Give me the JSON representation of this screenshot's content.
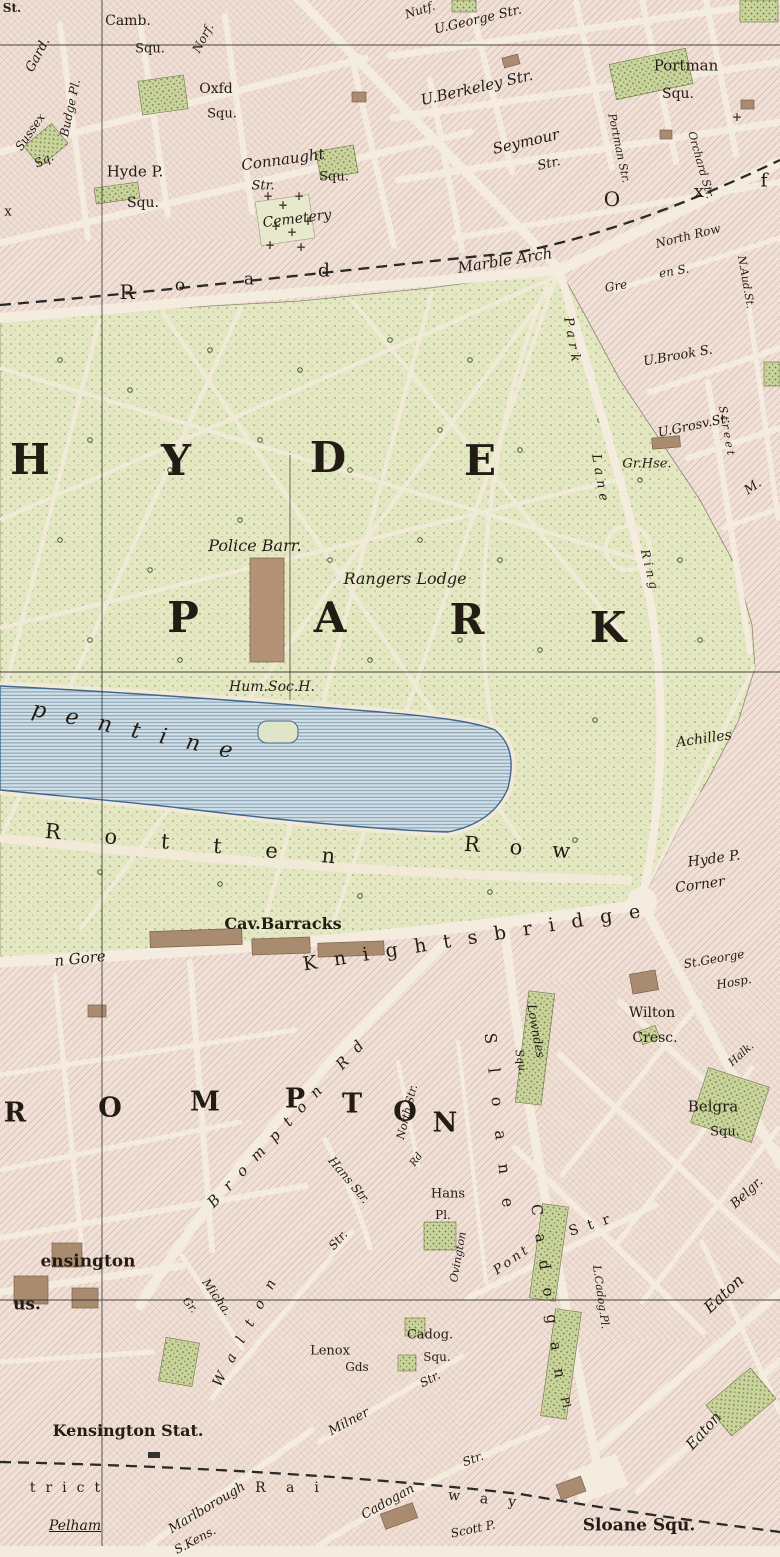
{
  "map": {
    "title": "Hyde Park and Knightsbridge district map sheet",
    "colors": {
      "paper": "#f4ecdf",
      "block_base": "#f0e1d8",
      "block_hatch": "#d3ab9d",
      "park_green": "#e3e8c2",
      "garden_green": "#c9d49c",
      "water_fill": "#d3e0e6",
      "water_ripple": "#7d9cb0",
      "water_outline": "#3f688c",
      "building_brown": "#a98b70",
      "ink": "#221c14"
    },
    "labels": [
      {
        "t": "St.",
        "x": 12,
        "y": 8,
        "s": 12,
        "c": "b"
      },
      {
        "t": "Gard.",
        "x": 38,
        "y": 55,
        "s": 13,
        "r": -62,
        "c": "it"
      },
      {
        "t": "Camb.",
        "x": 128,
        "y": 21,
        "s": 14
      },
      {
        "t": "Squ.",
        "x": 150,
        "y": 49,
        "s": 13
      },
      {
        "t": "Norf.",
        "x": 203,
        "y": 38,
        "s": 12,
        "r": -62,
        "c": "it"
      },
      {
        "t": "Nutf.",
        "x": 420,
        "y": 10,
        "s": 12,
        "r": -18,
        "c": "it"
      },
      {
        "t": "U.George Str.",
        "x": 478,
        "y": 20,
        "s": 13,
        "r": -13,
        "c": "it"
      },
      {
        "t": "Portman",
        "x": 686,
        "y": 66,
        "s": 15
      },
      {
        "t": "Squ.",
        "x": 678,
        "y": 94,
        "s": 14
      },
      {
        "t": "Budge Pl.",
        "x": 70,
        "y": 108,
        "s": 12,
        "r": -78,
        "c": "it"
      },
      {
        "t": "Oxfd",
        "x": 216,
        "y": 89,
        "s": 14
      },
      {
        "t": "Squ.",
        "x": 222,
        "y": 114,
        "s": 13
      },
      {
        "t": "Sussex",
        "x": 30,
        "y": 132,
        "s": 12,
        "r": -55,
        "c": "it"
      },
      {
        "t": "Sq.",
        "x": 44,
        "y": 160,
        "s": 12,
        "r": -25,
        "c": "it"
      },
      {
        "t": "U.Berkeley Str.",
        "x": 477,
        "y": 88,
        "s": 15,
        "r": -13,
        "c": "it"
      },
      {
        "t": "Connaught",
        "x": 283,
        "y": 160,
        "s": 15,
        "r": -8,
        "c": "it"
      },
      {
        "t": "Str.",
        "x": 263,
        "y": 186,
        "s": 13,
        "c": "it"
      },
      {
        "t": "Squ.",
        "x": 334,
        "y": 177,
        "s": 13
      },
      {
        "t": "Hyde P.",
        "x": 135,
        "y": 172,
        "s": 15
      },
      {
        "t": "Squ.",
        "x": 143,
        "y": 203,
        "s": 14
      },
      {
        "t": "Seymour",
        "x": 526,
        "y": 142,
        "s": 15,
        "r": -13,
        "c": "it"
      },
      {
        "t": "Str.",
        "x": 549,
        "y": 164,
        "s": 13,
        "r": -13,
        "c": "it"
      },
      {
        "t": "Portman Str.",
        "x": 619,
        "y": 148,
        "s": 11,
        "r": 78,
        "c": "it"
      },
      {
        "t": "Orchard Str.",
        "x": 701,
        "y": 165,
        "s": 11,
        "r": 74,
        "c": "it"
      },
      {
        "t": "Cemetery",
        "x": 297,
        "y": 219,
        "s": 14,
        "r": -7,
        "c": "it"
      },
      {
        "t": "Marble Arch",
        "x": 505,
        "y": 261,
        "s": 15,
        "r": -9,
        "c": "it"
      },
      {
        "t": "R",
        "x": 127,
        "y": 292,
        "s": 20
      },
      {
        "t": "o",
        "x": 180,
        "y": 286,
        "s": 17
      },
      {
        "t": "a",
        "x": 249,
        "y": 280,
        "s": 17
      },
      {
        "t": "d",
        "x": 324,
        "y": 271,
        "s": 19
      },
      {
        "t": "O",
        "x": 612,
        "y": 199,
        "s": 20
      },
      {
        "t": "x",
        "x": 699,
        "y": 192,
        "s": 18
      },
      {
        "t": "f",
        "x": 764,
        "y": 181,
        "s": 19
      },
      {
        "t": "North Row",
        "x": 688,
        "y": 236,
        "s": 12,
        "r": -14,
        "c": "it"
      },
      {
        "t": "Gre",
        "x": 616,
        "y": 286,
        "s": 12,
        "r": -10,
        "c": "it"
      },
      {
        "t": "en S.",
        "x": 674,
        "y": 271,
        "s": 12,
        "r": -10,
        "c": "it"
      },
      {
        "t": "N.Aud.St.",
        "x": 746,
        "y": 282,
        "s": 11,
        "r": 80,
        "c": "it"
      },
      {
        "t": "U.Brook S.",
        "x": 678,
        "y": 356,
        "s": 13,
        "r": -10,
        "c": "it"
      },
      {
        "t": "U.Grosv.St.",
        "x": 694,
        "y": 426,
        "s": 13,
        "r": -12,
        "c": "it"
      },
      {
        "t": "Gr.Hse.",
        "x": 647,
        "y": 464,
        "s": 13,
        "c": "it"
      },
      {
        "t": "Street",
        "x": 727,
        "y": 432,
        "s": 11,
        "r": 80,
        "ls": 3,
        "c": "it"
      },
      {
        "t": "M.",
        "x": 753,
        "y": 487,
        "s": 13,
        "r": -35,
        "c": "it"
      },
      {
        "t": "Park",
        "x": 572,
        "y": 342,
        "s": 13,
        "r": 80,
        "ls": 5,
        "c": "it"
      },
      {
        "t": "Lane",
        "x": 600,
        "y": 480,
        "s": 13,
        "r": 80,
        "ls": 5,
        "c": "it"
      },
      {
        "t": "Ring",
        "x": 650,
        "y": 571,
        "s": 12,
        "r": 76,
        "ls": 4,
        "c": "it"
      },
      {
        "t": "H",
        "x": 30,
        "y": 460,
        "s": 42,
        "c": "big"
      },
      {
        "t": "Y",
        "x": 176,
        "y": 461,
        "s": 42,
        "c": "big"
      },
      {
        "t": "D",
        "x": 328,
        "y": 458,
        "s": 42,
        "c": "big"
      },
      {
        "t": "E",
        "x": 480,
        "y": 461,
        "s": 42,
        "c": "big"
      },
      {
        "t": "P",
        "x": 183,
        "y": 618,
        "s": 42,
        "c": "big"
      },
      {
        "t": "A",
        "x": 330,
        "y": 618,
        "s": 42,
        "c": "big"
      },
      {
        "t": "R",
        "x": 467,
        "y": 620,
        "s": 42,
        "c": "big"
      },
      {
        "t": "K",
        "x": 608,
        "y": 628,
        "s": 42,
        "c": "big"
      },
      {
        "t": "Police Barr.",
        "x": 255,
        "y": 546,
        "s": 16,
        "c": "it"
      },
      {
        "t": "Rangers Lodge",
        "x": 405,
        "y": 579,
        "s": 16,
        "c": "it"
      },
      {
        "t": "Hum.Soc.H.",
        "x": 272,
        "y": 687,
        "s": 14,
        "c": "it"
      },
      {
        "t": "Achilles",
        "x": 704,
        "y": 739,
        "s": 14,
        "r": -8,
        "c": "it"
      },
      {
        "t": "pentine",
        "x": 142,
        "y": 733,
        "s": 22,
        "r": 12,
        "ls": 20,
        "c": "it"
      },
      {
        "t": "Rotten",
        "x": 212,
        "y": 846,
        "s": 21,
        "r": 5,
        "ls": 44
      },
      {
        "t": "Row",
        "x": 532,
        "y": 849,
        "s": 21,
        "r": 4,
        "ls": 30
      },
      {
        "t": "Cav.Barracks",
        "x": 283,
        "y": 924,
        "s": 16,
        "c": "b"
      },
      {
        "t": "n Gore",
        "x": 80,
        "y": 959,
        "s": 15,
        "r": -6,
        "c": "it"
      },
      {
        "t": "Knightsbridge",
        "x": 480,
        "y": 937,
        "s": 19,
        "r": -9,
        "ls": 17
      },
      {
        "t": "Hyde P.",
        "x": 714,
        "y": 859,
        "s": 14,
        "r": -8,
        "c": "it"
      },
      {
        "t": "Corner",
        "x": 700,
        "y": 885,
        "s": 14,
        "r": -8,
        "c": "it"
      },
      {
        "t": "St.George",
        "x": 714,
        "y": 959,
        "s": 12,
        "r": -10,
        "c": "it"
      },
      {
        "t": "Hosp.",
        "x": 734,
        "y": 982,
        "s": 12,
        "r": -10,
        "c": "it"
      },
      {
        "t": "Lowndes",
        "x": 536,
        "y": 1031,
        "s": 12,
        "r": 80,
        "c": "it"
      },
      {
        "t": "Squ.",
        "x": 521,
        "y": 1062,
        "s": 11,
        "r": 80,
        "c": "it"
      },
      {
        "t": "Wilton",
        "x": 652,
        "y": 1013,
        "s": 14
      },
      {
        "t": "Cresc.",
        "x": 655,
        "y": 1038,
        "s": 14
      },
      {
        "t": "Halk.",
        "x": 741,
        "y": 1054,
        "s": 11,
        "r": -42,
        "c": "it"
      },
      {
        "t": "Belgra",
        "x": 713,
        "y": 1107,
        "s": 15
      },
      {
        "t": "Squ.",
        "x": 725,
        "y": 1132,
        "s": 13
      },
      {
        "t": "Sloane",
        "x": 500,
        "y": 1132,
        "s": 16,
        "r": 84,
        "ls": 24
      },
      {
        "t": "Ovington",
        "x": 458,
        "y": 1257,
        "s": 11,
        "r": -80,
        "c": "it"
      },
      {
        "t": "Cadogan",
        "x": 549,
        "y": 1300,
        "s": 15,
        "r": 82,
        "ls": 18
      },
      {
        "t": "Pl.",
        "x": 566,
        "y": 1404,
        "s": 11,
        "r": 80
      },
      {
        "t": "L.Cadog.Pl.",
        "x": 601,
        "y": 1297,
        "s": 11,
        "r": 82,
        "c": "it"
      },
      {
        "t": "Pont",
        "x": 512,
        "y": 1260,
        "s": 13,
        "r": -35,
        "ls": 3,
        "c": "it"
      },
      {
        "t": "Str",
        "x": 594,
        "y": 1224,
        "s": 14,
        "r": -18,
        "ls": 10
      },
      {
        "t": "Hans",
        "x": 448,
        "y": 1194,
        "s": 13
      },
      {
        "t": "Pl.",
        "x": 443,
        "y": 1215,
        "s": 12
      },
      {
        "t": "Hans Str.",
        "x": 349,
        "y": 1180,
        "s": 12,
        "r": 50,
        "c": "it"
      },
      {
        "t": "North Str.",
        "x": 407,
        "y": 1112,
        "s": 11,
        "r": -76,
        "c": "it"
      },
      {
        "t": "Rd",
        "x": 417,
        "y": 1160,
        "s": 10,
        "r": -55,
        "c": "it"
      },
      {
        "t": "R",
        "x": 15,
        "y": 1113,
        "s": 27,
        "c": "big"
      },
      {
        "t": "O",
        "x": 110,
        "y": 1108,
        "s": 27,
        "c": "big"
      },
      {
        "t": "M",
        "x": 205,
        "y": 1102,
        "s": 27,
        "c": "big"
      },
      {
        "t": "P",
        "x": 295,
        "y": 1099,
        "s": 27,
        "c": "big"
      },
      {
        "t": "T",
        "x": 352,
        "y": 1104,
        "s": 27,
        "c": "big"
      },
      {
        "t": "O",
        "x": 405,
        "y": 1112,
        "s": 27,
        "c": "big"
      },
      {
        "t": "N",
        "x": 445,
        "y": 1123,
        "s": 27,
        "c": "big"
      },
      {
        "t": "Brompton Rd",
        "x": 290,
        "y": 1120,
        "s": 15,
        "r": -47,
        "ls": 12,
        "c": "it"
      },
      {
        "t": "Micha.",
        "x": 217,
        "y": 1297,
        "s": 12,
        "r": 55,
        "c": "it"
      },
      {
        "t": "Gr.",
        "x": 190,
        "y": 1305,
        "s": 11,
        "r": 50,
        "c": "it"
      },
      {
        "t": "Lenox",
        "x": 330,
        "y": 1351,
        "s": 13
      },
      {
        "t": "Gds",
        "x": 357,
        "y": 1367,
        "s": 12
      },
      {
        "t": "Cadog.",
        "x": 430,
        "y": 1335,
        "s": 13
      },
      {
        "t": "Squ.",
        "x": 437,
        "y": 1357,
        "s": 12
      },
      {
        "t": "Milner",
        "x": 349,
        "y": 1422,
        "s": 13,
        "r": -28,
        "c": "it"
      },
      {
        "t": "Str.",
        "x": 430,
        "y": 1379,
        "s": 12,
        "r": -28,
        "c": "it"
      },
      {
        "t": "Walton",
        "x": 248,
        "y": 1327,
        "s": 14,
        "r": -62,
        "ls": 14,
        "c": "it"
      },
      {
        "t": "Str.",
        "x": 338,
        "y": 1240,
        "s": 12,
        "r": -48,
        "c": "it"
      },
      {
        "t": "ensington",
        "x": 88,
        "y": 1262,
        "s": 17,
        "c": "b"
      },
      {
        "t": "us.",
        "x": 27,
        "y": 1305,
        "s": 17,
        "c": "b"
      },
      {
        "t": "Kensington Stat.",
        "x": 128,
        "y": 1431,
        "s": 16,
        "c": "b"
      },
      {
        "t": "trict",
        "x": 70,
        "y": 1488,
        "s": 14,
        "ls": 10
      },
      {
        "t": "Rai",
        "x": 297,
        "y": 1488,
        "s": 14,
        "ls": 20
      },
      {
        "t": "way",
        "x": 492,
        "y": 1500,
        "s": 14,
        "ls": 20,
        "r": 6
      },
      {
        "t": "Pelham",
        "x": 75,
        "y": 1526,
        "s": 14,
        "c": "it u"
      },
      {
        "t": "Marlborough",
        "x": 207,
        "y": 1508,
        "s": 13,
        "r": -31,
        "c": "it"
      },
      {
        "t": "S.Kens.",
        "x": 195,
        "y": 1540,
        "s": 12,
        "r": -28,
        "c": "it"
      },
      {
        "t": "Cadogan",
        "x": 388,
        "y": 1502,
        "s": 13,
        "r": -29,
        "c": "it"
      },
      {
        "t": "Str.",
        "x": 473,
        "y": 1459,
        "s": 12,
        "r": -20,
        "c": "it"
      },
      {
        "t": "Scott P.",
        "x": 473,
        "y": 1529,
        "s": 12,
        "r": -12,
        "c": "it"
      },
      {
        "t": "Sloane Squ.",
        "x": 639,
        "y": 1526,
        "s": 17,
        "c": "b"
      },
      {
        "t": "Eaton",
        "x": 724,
        "y": 1294,
        "s": 16,
        "r": -43,
        "c": "it"
      },
      {
        "t": "Eaton",
        "x": 704,
        "y": 1431,
        "s": 15,
        "r": -48,
        "c": "it"
      },
      {
        "t": "Belgr.",
        "x": 747,
        "y": 1193,
        "s": 13,
        "r": -43,
        "c": "it"
      },
      {
        "t": "x",
        "x": 8,
        "y": 212,
        "s": 13
      }
    ],
    "cemetery_crosses": [
      {
        "x": 268,
        "y": 196
      },
      {
        "x": 283,
        "y": 205
      },
      {
        "x": 299,
        "y": 196
      },
      {
        "x": 276,
        "y": 226
      },
      {
        "x": 292,
        "y": 232
      },
      {
        "x": 308,
        "y": 221
      },
      {
        "x": 270,
        "y": 245
      },
      {
        "x": 301,
        "y": 247
      },
      {
        "x": 737,
        "y": 117
      }
    ]
  }
}
